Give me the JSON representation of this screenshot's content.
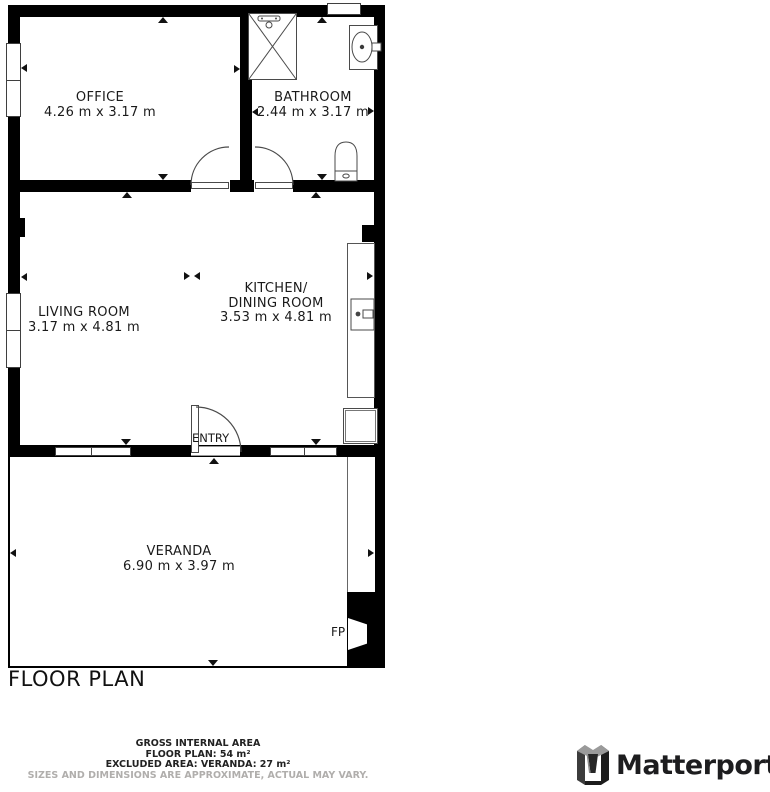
{
  "title": "FLOOR PLAN",
  "rooms": {
    "office": {
      "name": "OFFICE",
      "dims": "4.26 m x 3.17 m"
    },
    "bathroom": {
      "name": "BATHROOM",
      "dims": "2.44 m x 3.17 m"
    },
    "living": {
      "name": "LIVING ROOM",
      "dims": "3.17 m x 4.81 m"
    },
    "kitchen": {
      "name_line1": "KITCHEN/",
      "name_line2": "DINING ROOM",
      "dims": "3.53 m x 4.81 m"
    },
    "veranda": {
      "name": "VERANDA",
      "dims": "6.90 m x 3.97 m"
    }
  },
  "labels": {
    "entry": "ENTRY",
    "fireplace": "FP"
  },
  "footer": {
    "line1": "GROSS INTERNAL AREA",
    "line2": "FLOOR PLAN: 54 m²",
    "line3": "EXCLUDED AREA: VERANDA: 27 m²",
    "line4": "SIZES AND DIMENSIONS ARE APPROXIMATE, ACTUAL MAY VARY."
  },
  "branding": {
    "logo_text": "Matterport"
  },
  "colors": {
    "wall": "#000000",
    "line": "#4a4a4a",
    "text": "#1a1a1a",
    "muted": "#b0aeac"
  }
}
